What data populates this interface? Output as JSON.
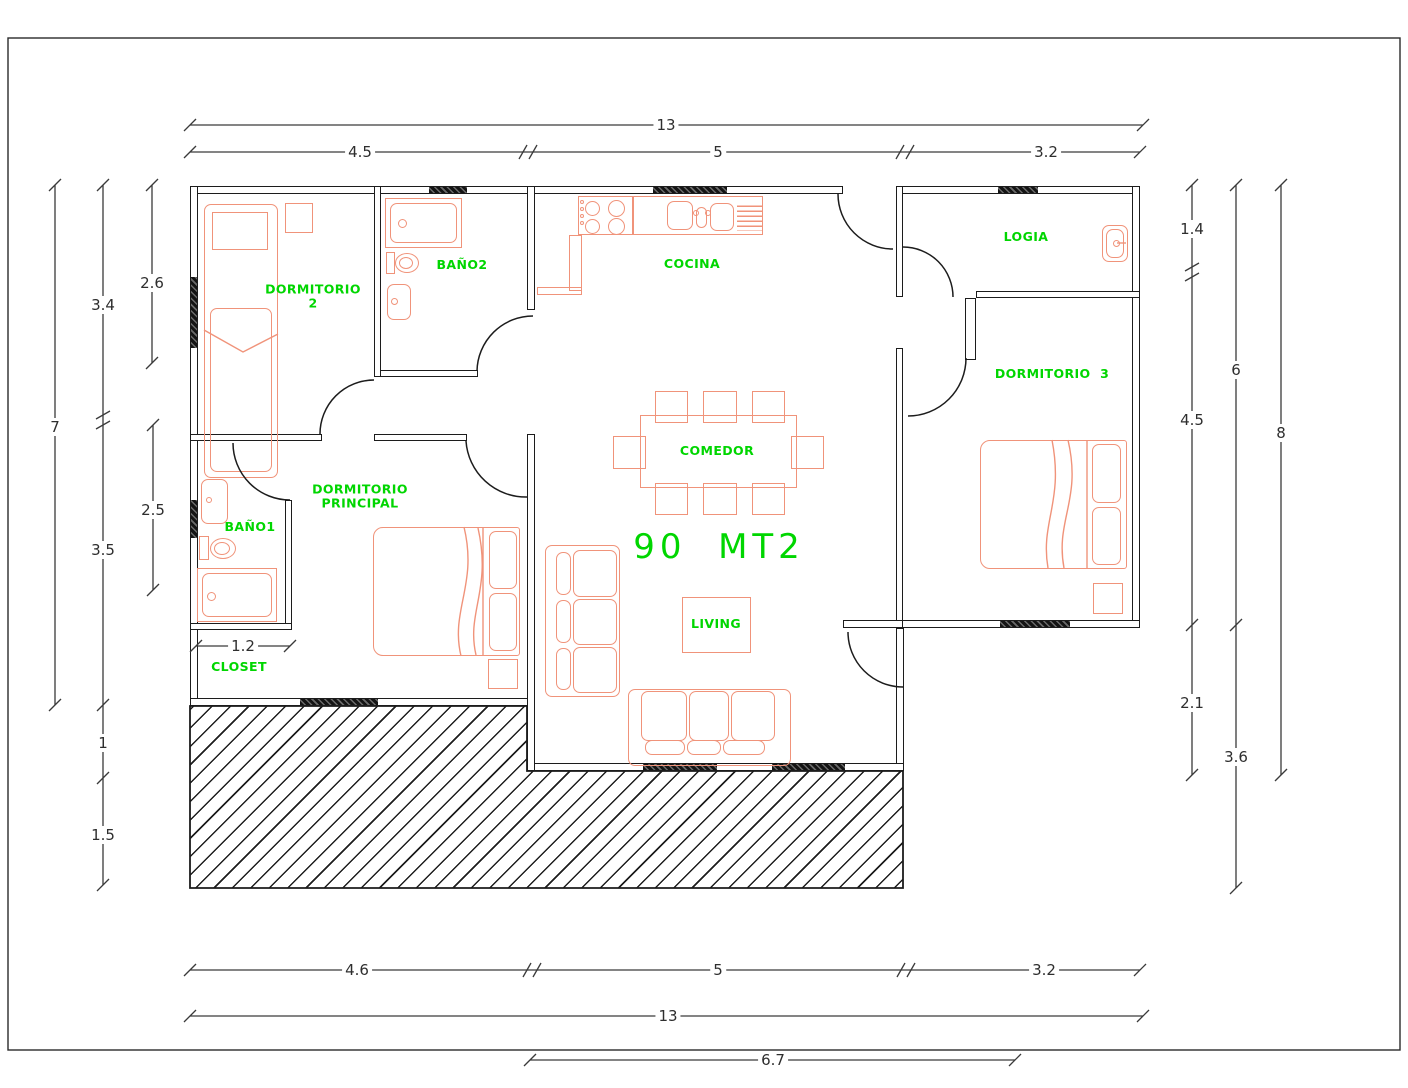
{
  "drawing": {
    "area_label": "90  MT2",
    "rooms": {
      "dormitorio2_line1": "DORMITORIO",
      "dormitorio2_line2": "2",
      "bano2": "BAÑO2",
      "cocina": "COCINA",
      "logia": "LOGIA",
      "dormitorio3": "DORMITORIO  3",
      "comedor": "COMEDOR",
      "living": "LIVING",
      "dormp_line1": "DORMITORIO",
      "dormp_line2": "PRINCIPAL",
      "bano1": "BAÑO1",
      "closet": "CLOSET"
    },
    "dims": {
      "top_total": "13",
      "top_a": "4.5",
      "top_b": "5",
      "top_c": "3.2",
      "bottom_a": "4.6",
      "bottom_b": "5",
      "bottom_c": "3.2",
      "bottom_total": "13",
      "bottom_porch": "6.7",
      "left_total": "7",
      "left_a": "3.4",
      "left_b": "3.5",
      "left_c": "1",
      "left_d": "1.5",
      "left_e": "2.6",
      "left_f": "2.5",
      "right_a": "1.4",
      "right_b": "4.5",
      "right_c": "2.1",
      "right_d": "6",
      "right_e": "3.6",
      "right_total": "8",
      "closet_width": "1.2"
    },
    "colors": {
      "wall": "#1c1c1c",
      "furniture": "#f0937a",
      "label": "#00d600",
      "dimension": "#3a3a3a"
    }
  }
}
